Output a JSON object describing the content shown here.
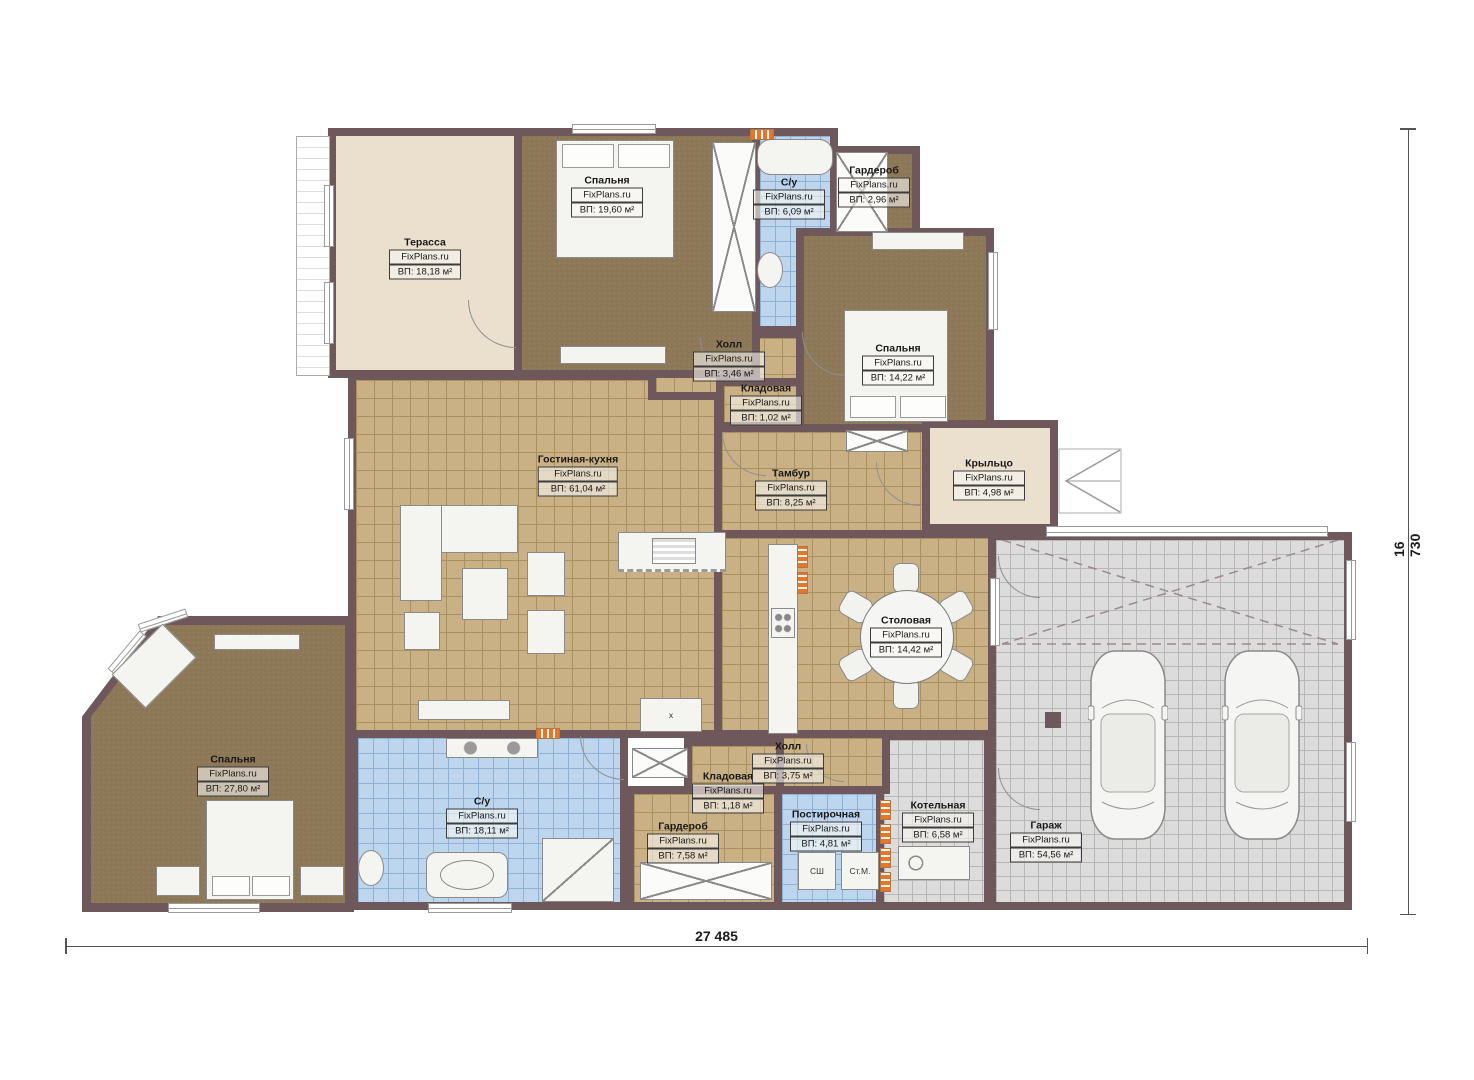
{
  "brand": "FixPlans.ru",
  "dimensions": {
    "bottom": "27 485",
    "right": "16 730"
  },
  "appliances": {
    "dryer": "СШ",
    "washer": "Ст.М."
  },
  "symbols": {
    "side_table_cross": "x"
  },
  "colors": {
    "wall": "#6e585c",
    "tile_tan": "#c9b185",
    "carpet_brown": "#8c7857",
    "tile_blue": "#bdd6ee",
    "tile_gray": "#dcdcdc",
    "terrace_beige": "#eae0cd",
    "heater_orange": "#e8762a"
  },
  "rooms": [
    {
      "name": "Терасса",
      "area": "ВП: 18,18 м²"
    },
    {
      "name": "Спальня",
      "area": "ВП: 19,60 м²"
    },
    {
      "name": "С/у",
      "area": "ВП: 6,09 м²"
    },
    {
      "name": "Гардероб",
      "area": "ВП: 2,96 м²"
    },
    {
      "name": "Спальня",
      "area": "ВП: 14,22 м²"
    },
    {
      "name": "Холл",
      "area": "ВП: 3,46 м²"
    },
    {
      "name": "Кладовая",
      "area": "ВП: 1,02 м²"
    },
    {
      "name": "Гостиная-кухня",
      "area": "ВП: 61,04 м²"
    },
    {
      "name": "Тамбур",
      "area": "ВП: 8,25 м²"
    },
    {
      "name": "Крыльцо",
      "area": "ВП: 4,98 м²"
    },
    {
      "name": "Столовая",
      "area": "ВП: 14,42 м²"
    },
    {
      "name": "Спальня",
      "area": "ВП: 27,80 м²"
    },
    {
      "name": "С/у",
      "area": "ВП: 18,11 м²"
    },
    {
      "name": "Гардероб",
      "area": "ВП: 7,58 м²"
    },
    {
      "name": "Кладовая",
      "area": "ВП: 1,18 м²"
    },
    {
      "name": "Холл",
      "area": "ВП: 3,75 м²"
    },
    {
      "name": "Постирочная",
      "area": "ВП: 4,81 м²"
    },
    {
      "name": "Котельная",
      "area": "ВП: 6,58 м²"
    },
    {
      "name": "Гараж",
      "area": "ВП: 54,56 м²"
    }
  ]
}
